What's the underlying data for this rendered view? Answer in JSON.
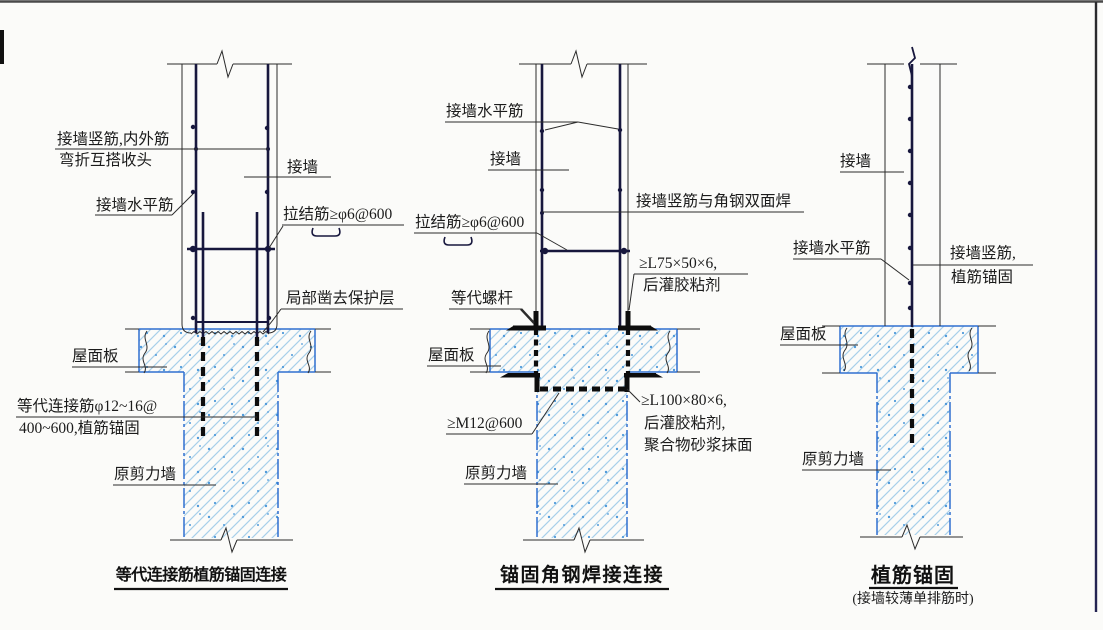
{
  "palette": {
    "paper": "#fbfbf9",
    "line_black": "#2b2b2b",
    "rebar_navy": "#17173d",
    "steel_black": "#0d0d0d",
    "concrete_blue": "#2f6fd0",
    "hatch_blue": "#a8cfe9",
    "speck_blue": "#4f9ada",
    "text_black": "#1b1b1b"
  },
  "diagrams": [
    {
      "title": "等代连接筋植筋锚固连接",
      "labels": {
        "vertical_rebar_note_1": "接墙竖筋,内外筋",
        "vertical_rebar_note_2": "弯折互搭收头",
        "wall": "接墙",
        "horizontal_rebar": "接墙水平筋",
        "tie_bar": "拉结筋≥φ6@600",
        "chisel_note": "局部凿去保护层",
        "roof_slab": "屋面板",
        "equiv_rebar_note_1": "等代连接筋φ12~16@",
        "equiv_rebar_note_2": "400~600,植筋锚固",
        "original_shear_wall": "原剪力墙"
      }
    },
    {
      "title": "锚固角钢焊接连接",
      "labels": {
        "horizontal_rebar": "接墙水平筋",
        "wall": "接墙",
        "weld_note": "接墙竖筋与角钢双面焊",
        "tie_bar": "拉结筋≥φ6@600",
        "top_angle_note_1": "≥L75×50×6,",
        "top_angle_note_2": "后灌胶粘剂",
        "equiv_bolt": "等代螺杆",
        "roof_slab": "屋面板",
        "anchor_bolt": "≥M12@600",
        "bottom_angle_note_1": "≥L100×80×6,",
        "bottom_angle_note_2": "后灌胶粘剂,",
        "bottom_angle_note_3": "聚合物砂浆抹面",
        "original_shear_wall": "原剪力墙"
      }
    },
    {
      "title": "植筋锚固",
      "subtitle": "(接墙较薄单排筋时)",
      "labels": {
        "wall": "接墙",
        "horizontal_rebar": "接墙水平筋",
        "vertical_rebar_note_1": "接墙竖筋,",
        "vertical_rebar_note_2": "植筋锚固",
        "roof_slab": "屋面板",
        "original_shear_wall": "原剪力墙"
      }
    }
  ]
}
